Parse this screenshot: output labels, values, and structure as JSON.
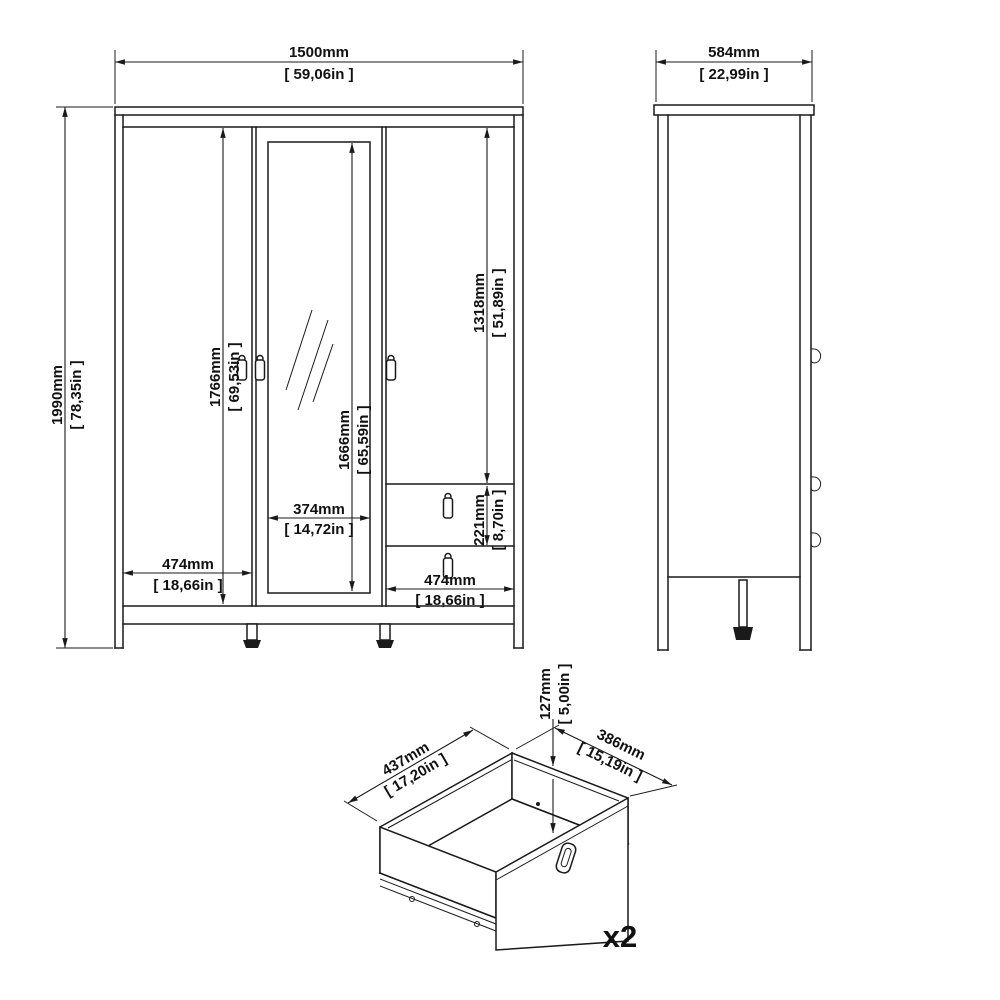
{
  "drawing": {
    "front": {
      "width_mm": "1500mm",
      "width_in": "[ 59,06in ]",
      "height_mm": "1990mm",
      "height_in": "[ 78,35in ]",
      "left_door_mm": "1766mm",
      "left_door_in": "[ 69,53in ]",
      "mirror_h_mm": "1666mm",
      "mirror_h_in": "[ 65,59in ]",
      "right_door_mm": "1318mm",
      "right_door_in": "[ 51,89in ]",
      "drawer_mm": "221mm",
      "drawer_in": "[ 8,70in ]",
      "mirror_w_mm": "374mm",
      "mirror_w_in": "[ 14,72in ]",
      "left_w_mm": "474mm",
      "left_w_in": "[ 18,66in ]",
      "right_w_mm": "474mm",
      "right_w_in": "[ 18,66in ]"
    },
    "side": {
      "depth_mm": "584mm",
      "depth_in": "[ 22,99in ]"
    },
    "drawer": {
      "width_mm": "437mm",
      "width_in": "[ 17,20in ]",
      "depth_mm": "386mm",
      "depth_in": "[ 15,19in ]",
      "height_mm": "127mm",
      "height_in": "[ 5,00in ]",
      "quantity": "x2"
    }
  },
  "colors": {
    "line": "#1a1a1a",
    "background": "#ffffff"
  }
}
